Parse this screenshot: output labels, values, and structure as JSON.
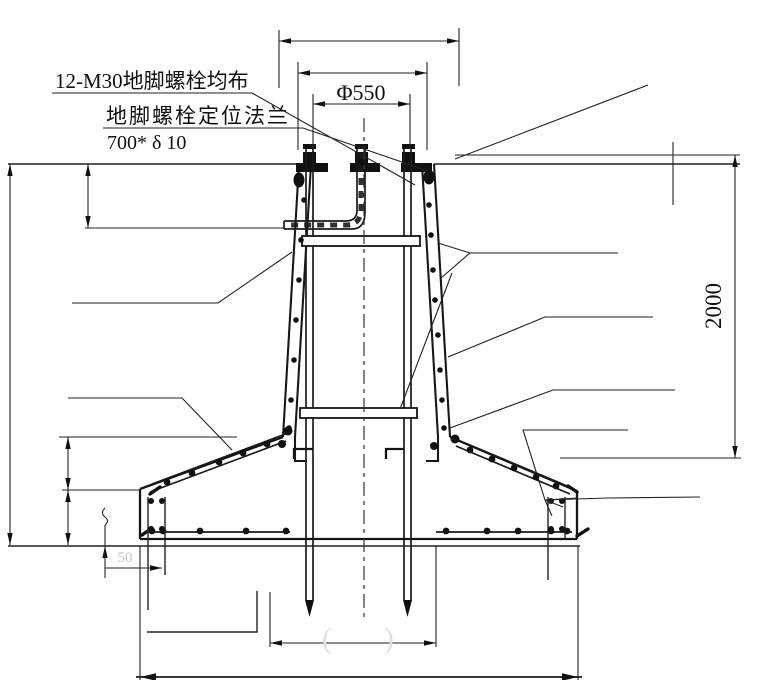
{
  "drawing": {
    "type": "foundation-cross-section",
    "annotations": {
      "bolt_note": "12-M30地脚螺栓均布",
      "flange_note": "地脚螺栓定位法兰",
      "flange_size": "700* δ 10"
    },
    "dimensions": {
      "bolt_circle": "Φ550",
      "pedestal_height": "2000",
      "edge_offset": "50",
      "faded_left": "(",
      "faded_right": ")"
    },
    "colors": {
      "line": "#1f1f1f",
      "faded_text": "#c6c6c6",
      "background": "#ffffff"
    }
  }
}
